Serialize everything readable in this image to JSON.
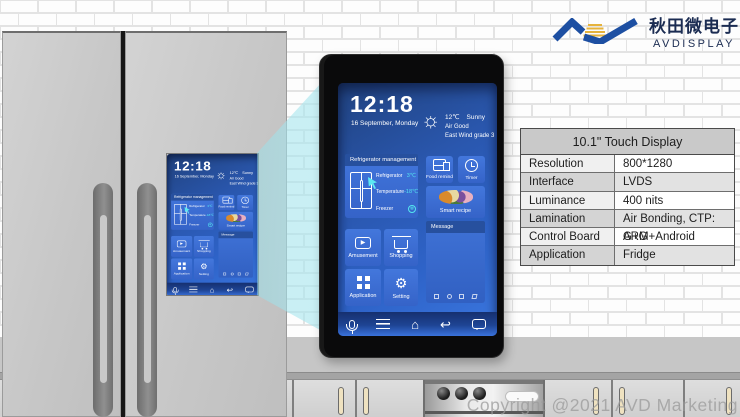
{
  "brand": {
    "logo_cn": "秋田微电子",
    "logo_en": "AVDISPLAY",
    "logo_blue": "#1d4fa2",
    "logo_gold": "#e6b33c"
  },
  "watermark": "Copyright @2021 AVD Marketing",
  "spec_table": {
    "title": "10.1\" Touch Display",
    "rows": [
      {
        "label": "Resolution",
        "value": "800*1280"
      },
      {
        "label": "Interface",
        "value": "LVDS"
      },
      {
        "label": "Luminance",
        "value": "400 nits"
      },
      {
        "label": "Lamination",
        "value": "Air Bonding, CTP: G+G"
      },
      {
        "label": "Control Board",
        "value": "ARM+Android"
      },
      {
        "label": "Application",
        "value": "Fridge"
      }
    ]
  },
  "screen": {
    "time": "12:18",
    "date": "16 September, Monday",
    "weather": {
      "temp": "12℃",
      "condition": "Sunny",
      "air": "Air Good",
      "wind": "East Wind grade 3"
    },
    "fridge_panel": {
      "title": "Refrigerator management",
      "rows": [
        {
          "label": "Refrigerator",
          "value": "3℃"
        },
        {
          "label": "Temperature",
          "value": "-18℃"
        },
        {
          "label": "Freezer",
          "value": "❄"
        }
      ]
    },
    "tiles": {
      "food": "Food remind",
      "timer": "Timer",
      "recipe": "Smart recipe",
      "message": "Message",
      "amusement": "Amusement",
      "shopping": "Shopping",
      "application": "Application",
      "setting": "Setting"
    },
    "icons": {
      "sun": "☼",
      "snowflake": "❄",
      "play": "▶",
      "gear": "⚙",
      "home": "⌂",
      "back": "↩"
    },
    "colors": {
      "accent_cyan": "#54e6f0",
      "screen_blue": "#2e63c8",
      "tile_blue": "#3f72d8",
      "nav_blue": "#16306f"
    }
  }
}
